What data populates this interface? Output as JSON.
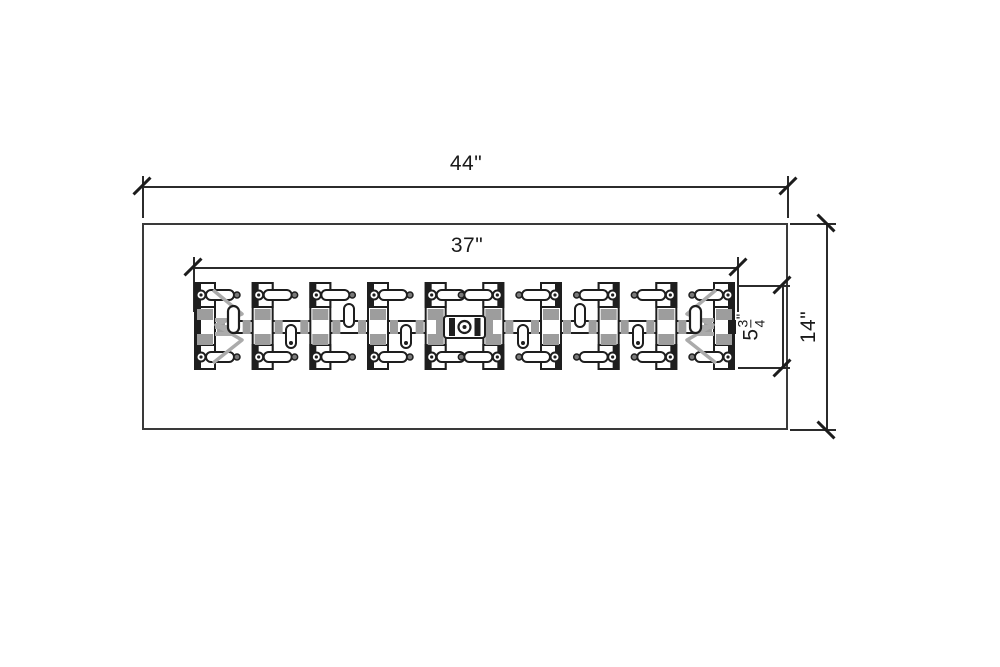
{
  "page": {
    "background": "#ffffff"
  },
  "drawing": {
    "description": "Top-view dimensioned technical drawing of a clip rail assembly inside a rectangular frame",
    "colors": {
      "line": "#1e1e1e",
      "frame": "#3a3a3a",
      "dim_line": "#2b2b2b",
      "pad_gray": "#9d9d9d",
      "spring_gray": "#ababab"
    },
    "dimensions": {
      "overall_width": "44\"",
      "rail_width": "37\"",
      "overall_height": "14\"",
      "clip_height": {
        "whole": "5",
        "numerator": "3",
        "denominator": "4",
        "unit": "\""
      }
    },
    "clip_count": 10
  }
}
